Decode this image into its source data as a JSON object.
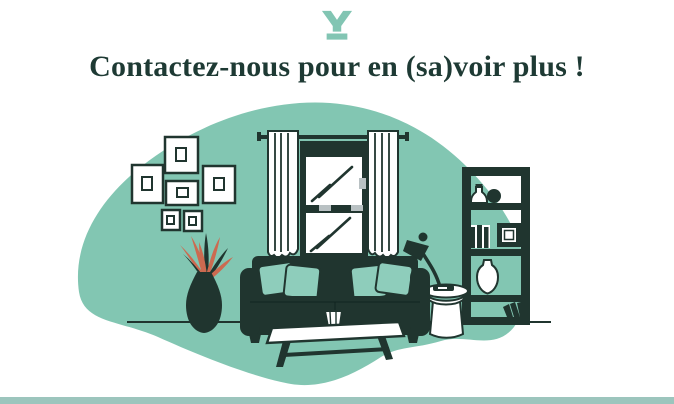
{
  "header": {
    "logo_icon": "y-brand-mark",
    "title": "Contactez-nous pour en (sa)voir plus !"
  },
  "illustration": {
    "scene": "living-room",
    "elements": [
      "organic-blob-background",
      "floor-line",
      "wall-picture-frames",
      "window-with-curtains",
      "plant-in-vase",
      "sofa-with-pillows",
      "coffee-table-with-vase",
      "side-table",
      "desk-lamp",
      "bookshelf-with-books-vase-frame"
    ],
    "frame_count": 6,
    "pillow_count": 4,
    "bookshelf_shelves": 4
  },
  "colors": {
    "accent_teal": "#82c6b2",
    "pillow_teal": "#8ecdbb",
    "ink_dark": "#20352f",
    "heading": "#1e3a34",
    "coral": "#cc6a50",
    "hardware_gray": "#b9c1c3",
    "footer_bar": "#9cc5bd",
    "logo_teal": "#82c5b3",
    "white": "#ffffff"
  }
}
